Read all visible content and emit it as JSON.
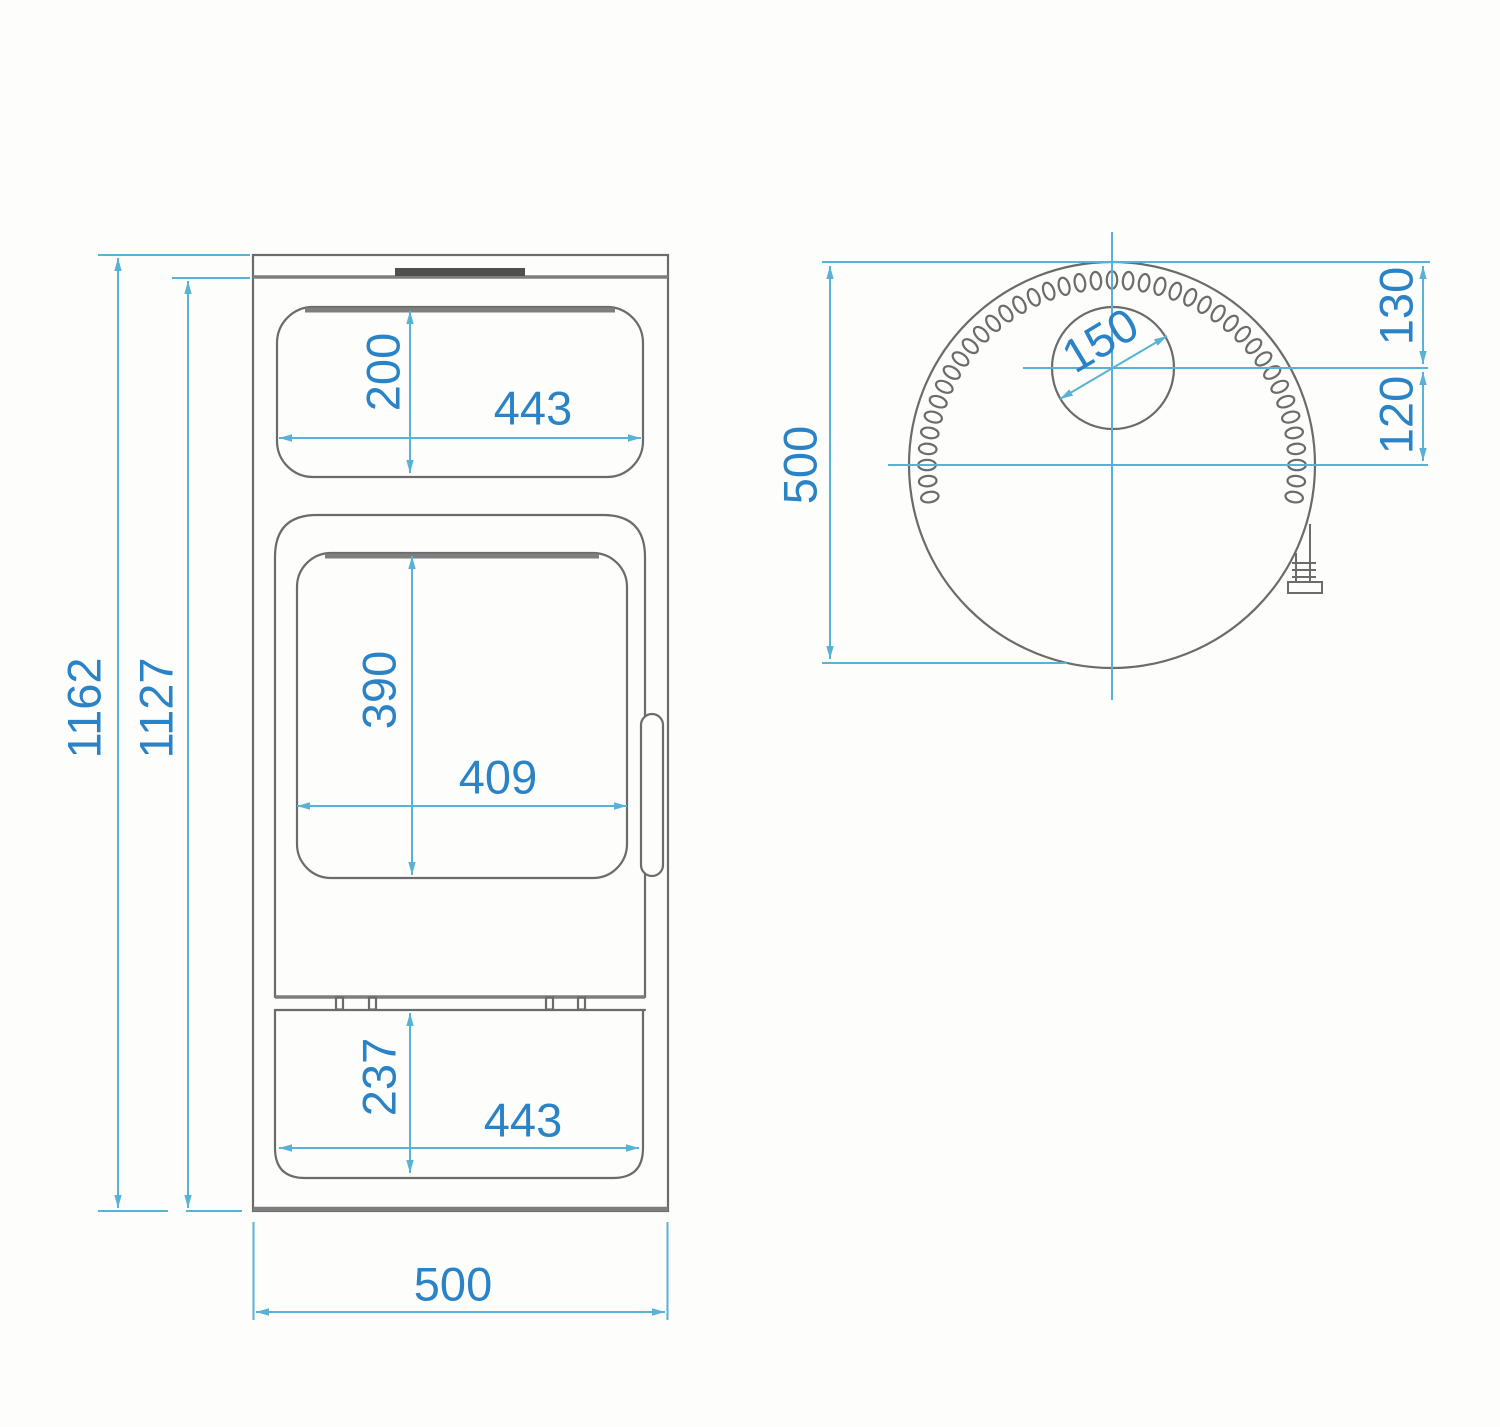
{
  "drawing": {
    "kind": "technical-dimension-drawing",
    "views": [
      "front-elevation",
      "top-plan"
    ]
  },
  "colors": {
    "background": "#fdfdfb",
    "outline": "#6b6b6b",
    "outline_heavy": "#7e7e7e",
    "outline_dark": "#4f4f4f",
    "dim_line": "#58b2d6",
    "dim_text": "#2a83c6"
  },
  "front_view": {
    "label": "front-elevation",
    "dims": {
      "overall_height": "1162",
      "body_height": "1127",
      "upper_window_height": "200",
      "upper_window_width": "443",
      "door_window_height": "390",
      "door_window_width": "409",
      "lower_compartment_height": "237",
      "lower_compartment_width": "443",
      "overall_width": "500"
    }
  },
  "top_view": {
    "label": "top-plan",
    "dims": {
      "depth": "500",
      "flue_diameter": "150",
      "back_to_flue_center": "130",
      "flue_center_to_axis": "120"
    },
    "vent_holes": {
      "count": 41
    }
  }
}
